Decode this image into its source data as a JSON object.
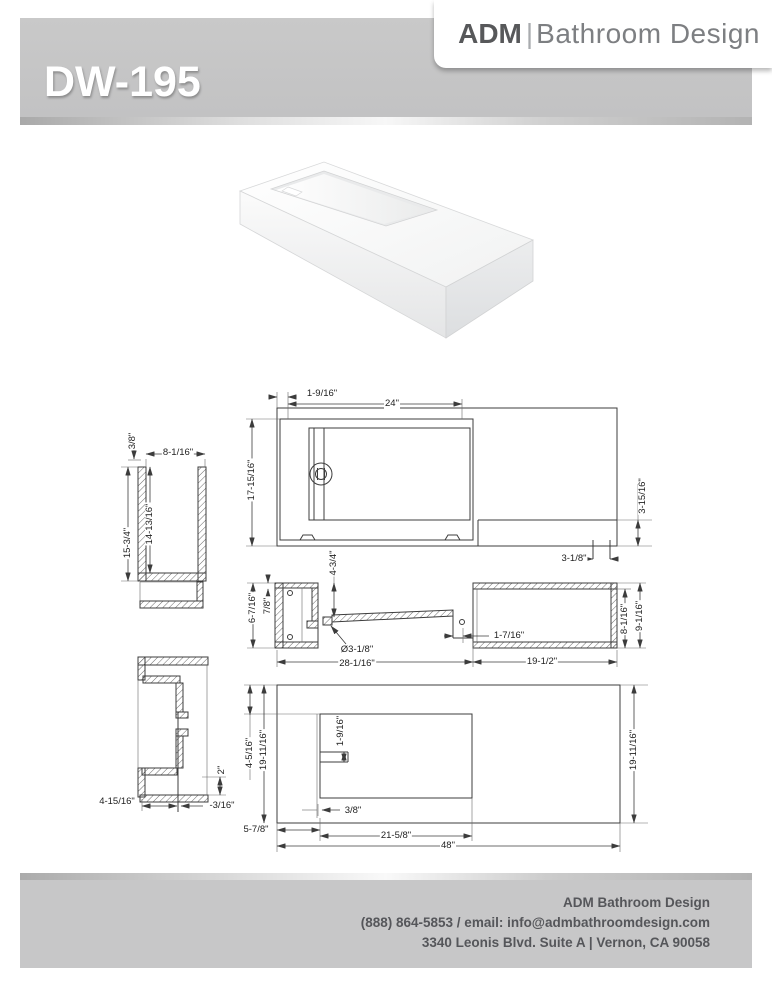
{
  "header": {
    "model": "DW-195",
    "brand": {
      "name": "ADM",
      "separator": "|",
      "suffix": "Bathroom Design"
    }
  },
  "footer": {
    "company": "ADM Bathroom Design",
    "phone_email": "(888) 864-5853 / email: info@admbathroomdesign.com",
    "address": "3340 Leonis Blvd. Suite A | Vernon, CA 90058"
  },
  "colors": {
    "banner_gray": "#c6c6c7",
    "footer_gray": "#c7c7c8",
    "brand_dark": "#57585a",
    "brand_light": "#7d7f82",
    "footer_text": "#55565a",
    "drawing_line": "#3c3c3c"
  },
  "drawings": {
    "dimension_labels": [
      {
        "text": "1-9/16\"",
        "x": 322,
        "y": 394,
        "rot": 0
      },
      {
        "text": "24\"",
        "x": 392,
        "y": 404,
        "rot": 0
      },
      {
        "text": "17-15/16\"",
        "x": 252,
        "y": 480,
        "rot": -90
      },
      {
        "text": "3-15/16\"",
        "x": 643,
        "y": 496,
        "rot": -90
      },
      {
        "text": "3-1/8\"",
        "x": 574,
        "y": 559,
        "rot": 0
      },
      {
        "text": "3/8\"",
        "x": 133,
        "y": 441,
        "rot": -90
      },
      {
        "text": "8-1/16\"",
        "x": 178,
        "y": 453,
        "rot": 0
      },
      {
        "text": "14-13/16\"",
        "x": 150,
        "y": 524,
        "rot": -90
      },
      {
        "text": "15-3/4\"",
        "x": 128,
        "y": 543,
        "rot": -90
      },
      {
        "text": "4-3/4\"",
        "x": 334,
        "y": 563,
        "rot": -90
      },
      {
        "text": "6-7/16\"",
        "x": 253,
        "y": 608,
        "rot": -90
      },
      {
        "text": "7/8\"",
        "x": 268,
        "y": 606,
        "rot": -90
      },
      {
        "text": "Ø3-1/8\"",
        "x": 357,
        "y": 650,
        "rot": 0
      },
      {
        "text": "28-1/16\"",
        "x": 357,
        "y": 664,
        "rot": 0
      },
      {
        "text": "1-7/16\"",
        "x": 509,
        "y": 636,
        "rot": 0
      },
      {
        "text": "19-1/2\"",
        "x": 542,
        "y": 662,
        "rot": 0
      },
      {
        "text": "8-1/16\"",
        "x": 625,
        "y": 619,
        "rot": -90
      },
      {
        "text": "9-1/16\"",
        "x": 640,
        "y": 616,
        "rot": -90
      },
      {
        "text": "4-15/16\"",
        "x": 117,
        "y": 802,
        "rot": 0
      },
      {
        "text": "-3/16\"",
        "x": 222,
        "y": 806,
        "rot": 0
      },
      {
        "text": "2\"",
        "x": 222,
        "y": 770,
        "rot": -90
      },
      {
        "text": "4-5/16\"",
        "x": 250,
        "y": 753,
        "rot": -90
      },
      {
        "text": "19-11/16\"",
        "x": 264,
        "y": 750,
        "rot": -90
      },
      {
        "text": "1-9/16\"",
        "x": 341,
        "y": 731,
        "rot": -90
      },
      {
        "text": "3/8\"",
        "x": 353,
        "y": 811,
        "rot": 0
      },
      {
        "text": "5-7/8\"",
        "x": 256,
        "y": 830,
        "rot": 0
      },
      {
        "text": "21-5/8\"",
        "x": 396,
        "y": 836,
        "rot": 0
      },
      {
        "text": "48\"",
        "x": 448,
        "y": 846,
        "rot": 0
      },
      {
        "text": "19-11/16\"",
        "x": 634,
        "y": 750,
        "rot": -90
      }
    ]
  }
}
